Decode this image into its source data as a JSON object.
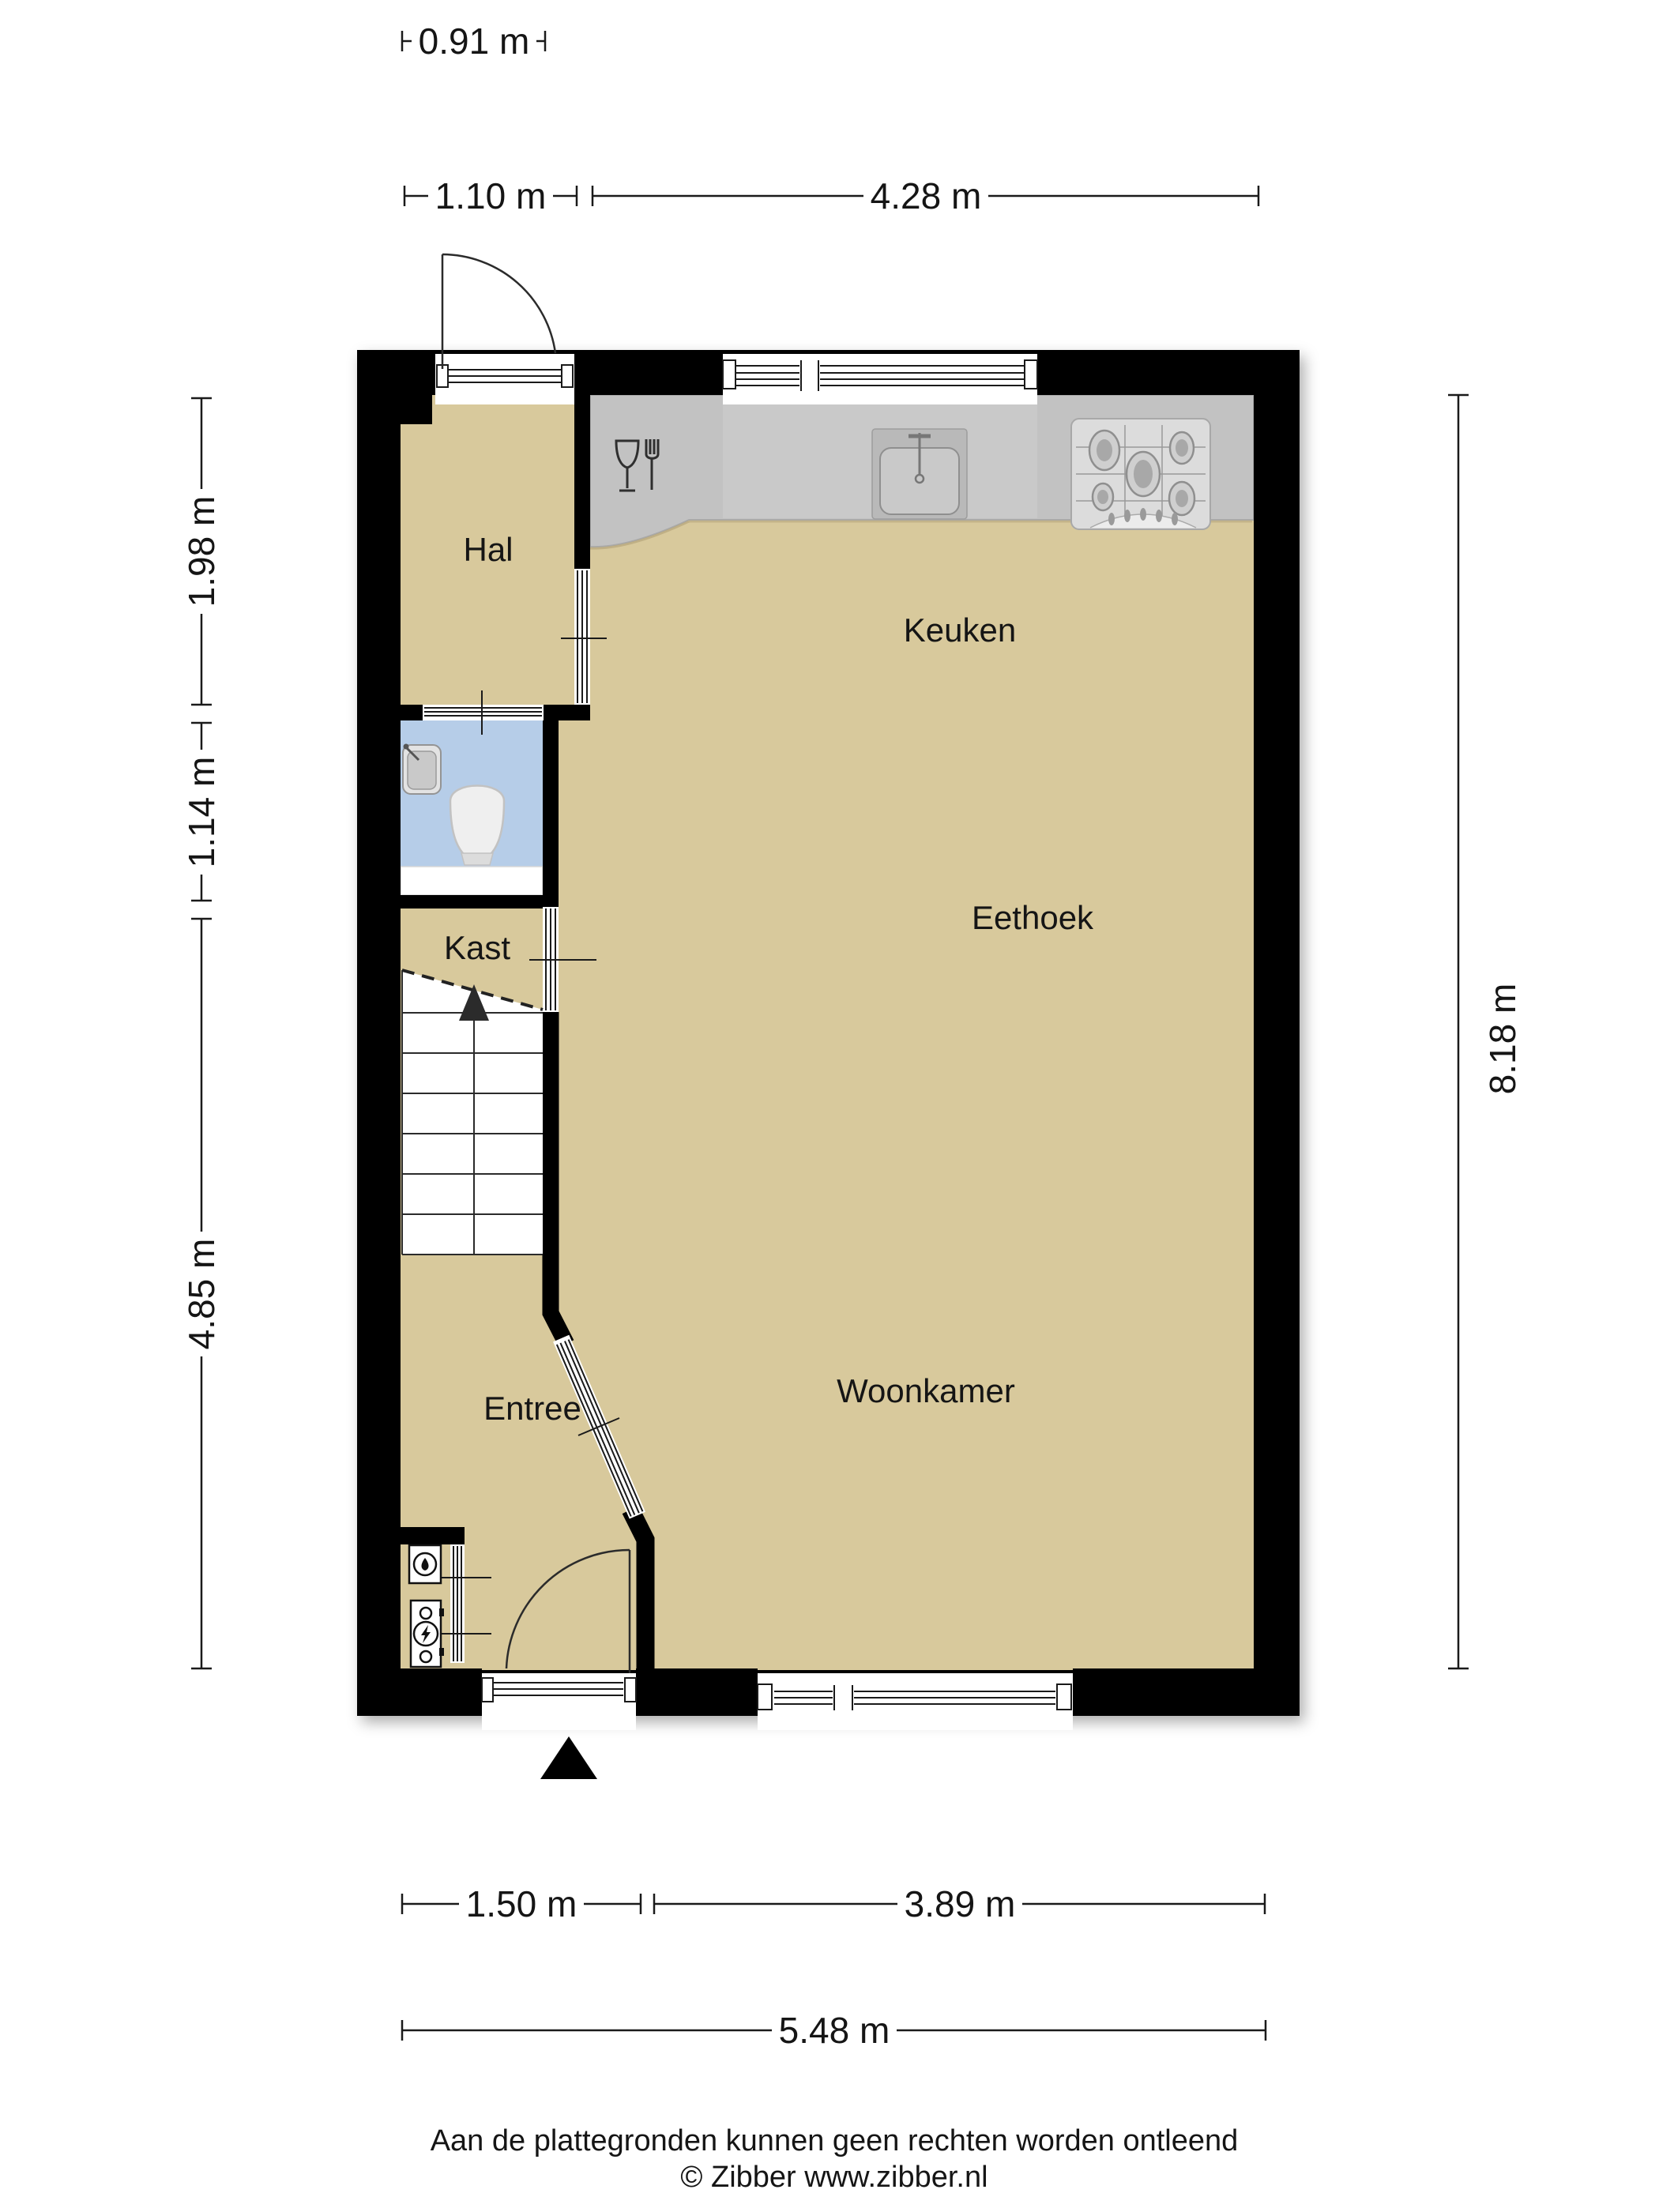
{
  "rooms": {
    "hal": "Hal",
    "keuken": "Keuken",
    "eethoek": "Eethoek",
    "kast": "Kast",
    "woonkamer": "Woonkamer",
    "entree": "Entree"
  },
  "dimensions": {
    "top_small": "0.91 m",
    "top_left": "1.10 m",
    "top_right": "4.28 m",
    "left_upper": "1.98 m",
    "left_middle": "1.14 m",
    "left_lower": "4.85 m",
    "right_full": "8.18 m",
    "bottom_left": "1.50 m",
    "bottom_right": "3.89 m",
    "bottom_full": "5.48 m"
  },
  "footer": {
    "disclaimer": "Aan de plattegronden kunnen geen rechten worden ontleend",
    "copyright": "© Zibber www.zibber.nl"
  },
  "icons": {
    "dishwasher": "wine-glass-and-fork",
    "kitchen_sink": "sink-with-faucet",
    "stove": "five-burner-gas-hob",
    "toilet": "toilet-bowl",
    "washbasin": "small-sink",
    "water_meter": "circle-drop-meter",
    "electricity_meter": "circle-lightning-meter",
    "entrance_marker": "black-triangle",
    "stairs_direction": "up-arrow"
  },
  "colors": {
    "wall": "#000000",
    "floor": "#d8c99c",
    "toilet_floor": "#b6cde8",
    "counter": "#c2c2c2",
    "counter_light": "#cccccc",
    "stove_panel": "#dcdcdc"
  }
}
